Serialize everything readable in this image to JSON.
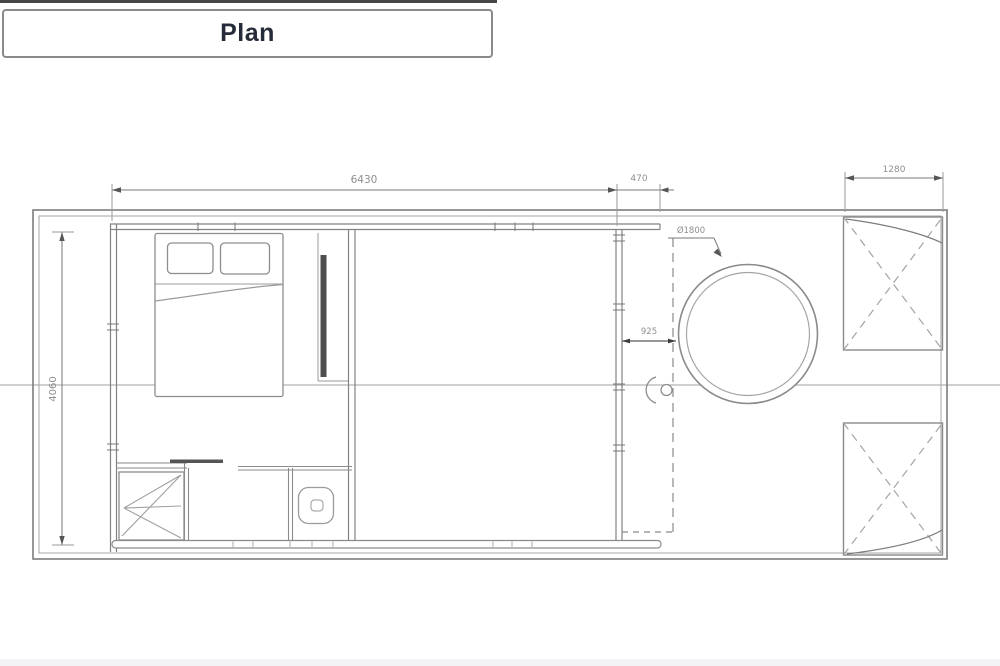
{
  "title": "Plan",
  "dimensions": {
    "cabin_length": "6430",
    "side_overhang": "470",
    "deck_width": "1280",
    "cabin_depth": "4060",
    "tub_clearance": "925",
    "tub_diameter": "Ø1800"
  },
  "elements": {
    "bed": "double-bed",
    "wardrobe_door": "sliding-pocket-door",
    "shower": "shower-tray",
    "toilet": "wc",
    "hot_tub": "round-hot-tub",
    "deck_panels": "fold-down-deck-hatch"
  },
  "colors": {
    "line": "#8a8a8a",
    "dark_line": "#4e4e4e",
    "dim_text": "#8f8f8f",
    "title_text": "#262b3a",
    "background": "#ffffff"
  }
}
